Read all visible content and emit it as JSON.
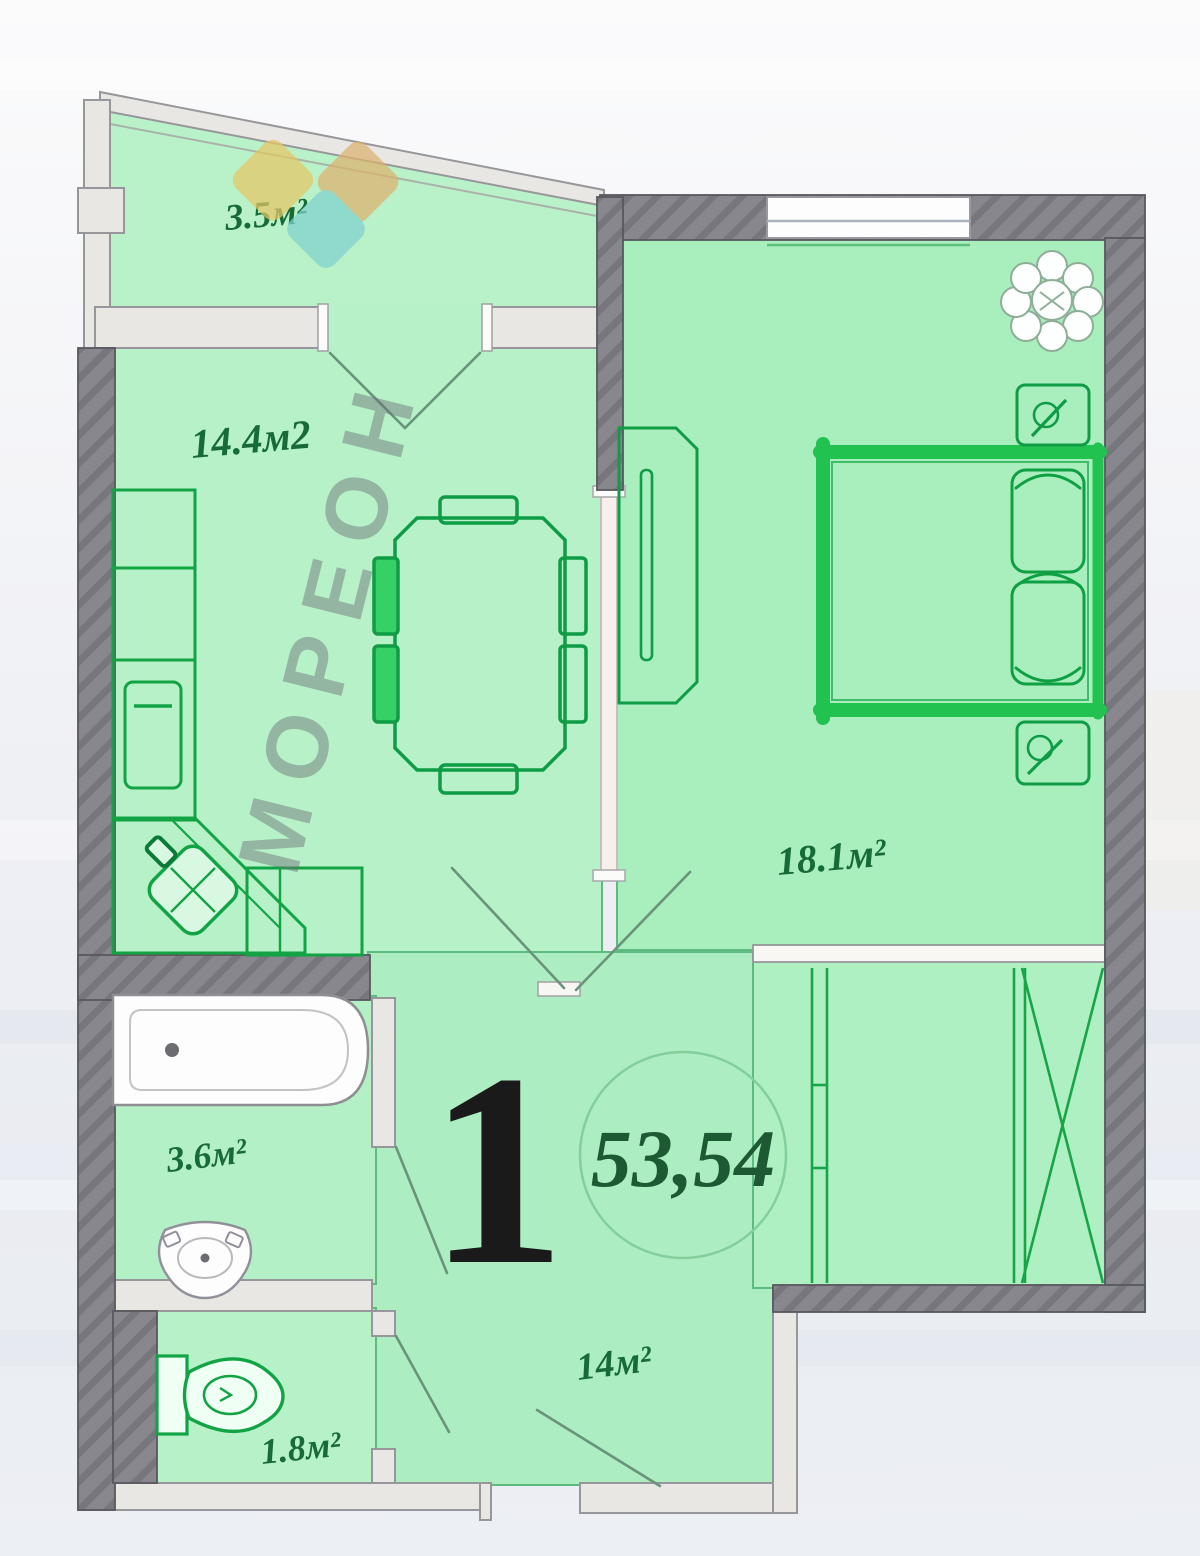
{
  "watermark": {
    "text": "МОРЕОН",
    "logo_colors": {
      "yellow": "#e5c766",
      "orange": "#ddb26e",
      "teal": "#7fd2cf"
    }
  },
  "apartment": {
    "number": "1",
    "total_area": "53,54"
  },
  "rooms": {
    "balcony": {
      "label": "3.5м²"
    },
    "kitchen": {
      "label": "14.4м2"
    },
    "bedroom": {
      "label": "18.1м²"
    },
    "bathroom": {
      "label": "3.6м²"
    },
    "wc": {
      "label": "1.8м²"
    },
    "hallway": {
      "label": "14м²"
    }
  },
  "colors": {
    "wall_dark": "#87878d",
    "wall_light": "#e9e7e3",
    "room_fill_light": "#b9f2c9",
    "room_fill": "#aceec0",
    "furniture_green": "#12a345",
    "bed_green": "#21c250",
    "label_green": "#176b37",
    "area_text_green": "#1d5a33",
    "number_black": "#1a1a1a"
  }
}
